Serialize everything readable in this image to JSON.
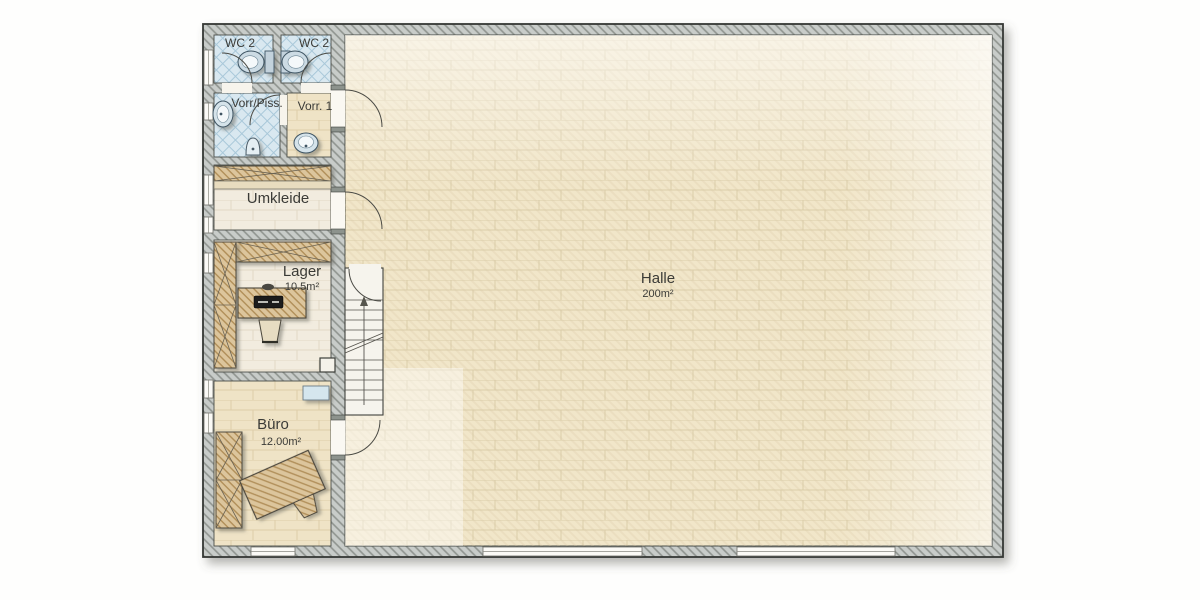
{
  "plan": {
    "type": "architectural-floorplan",
    "rooms": {
      "wc_left": {
        "label": "WC 2"
      },
      "wc_right": {
        "label": "WC 2"
      },
      "vorr_piss": {
        "label": "Vorr/Piss."
      },
      "vorr_1": {
        "label": "Vorr. 1"
      },
      "umkleide": {
        "label": "Umkleide"
      },
      "lager": {
        "label": "Lager",
        "area": "10.5m²"
      },
      "buero": {
        "label": "Büro",
        "area": "12.00m²"
      },
      "halle": {
        "label": "Halle",
        "area": "200m²"
      }
    },
    "fixtures": {
      "wc_left": [
        "toilet",
        "swing-door"
      ],
      "wc_right": [
        "toilet",
        "swing-door"
      ],
      "vorr_piss": [
        "washbasin",
        "urinal",
        "swing-door"
      ],
      "vorr_1": [
        "washbasin",
        "swing-door"
      ],
      "umkleide": [
        "locker-row",
        "bench",
        "swing-door"
      ],
      "lager": [
        "shelving-left",
        "shelving-top",
        "desk",
        "laptop",
        "office-chair",
        "service-box"
      ],
      "buero": [
        "wardrobe",
        "desk",
        "office-chair",
        "sink-unit",
        "swing-door"
      ],
      "halle": [
        "staircase-up",
        "windows",
        "doors"
      ]
    },
    "colors": {
      "wall_fill": "#c8ccc9",
      "wall_hatch": "#8f948f",
      "outline": "#35383434",
      "halle_floor": "#f1e6c9",
      "floor_cream": "#f2ecdf",
      "floor_beige": "#efe3c6",
      "wet_room_floor": "#d9e8f0",
      "wet_room_hatch": "#a9c8d9",
      "furniture_wood": "#dcc59c",
      "sanitary_blue": "#d5e3ea",
      "label_text": "#3b3b37"
    }
  }
}
